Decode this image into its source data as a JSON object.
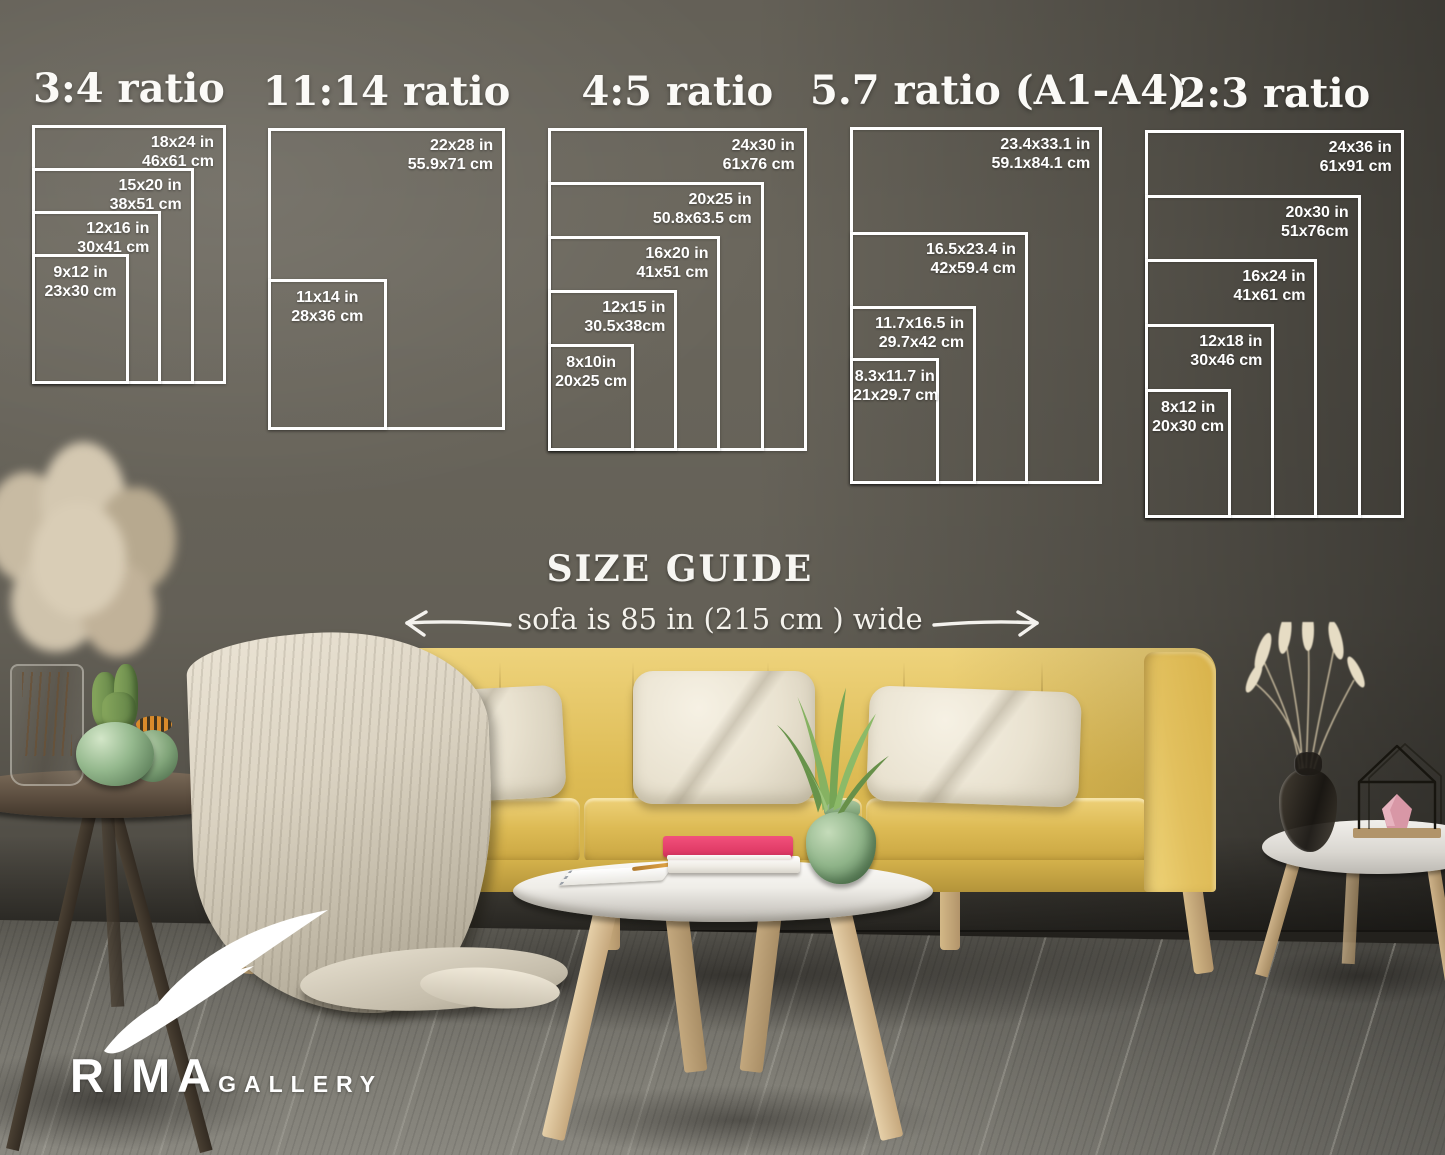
{
  "size_guide": {
    "heading": "SIZE GUIDE",
    "sofa_note": "sofa is 85 in (215 cm ) wide",
    "px_per_inch": 10.78,
    "frame_color": "#ffffff",
    "groups": [
      {
        "title": "3:4 ratio",
        "x": 32,
        "y": 125,
        "sizes": [
          {
            "w": 18,
            "h": 24,
            "inches": "18x24 in",
            "cm": "46x61 cm"
          },
          {
            "w": 15,
            "h": 20,
            "inches": "15x20 in",
            "cm": "38x51 cm"
          },
          {
            "w": 12,
            "h": 16,
            "inches": "12x16 in",
            "cm": "30x41 cm"
          },
          {
            "w": 9,
            "h": 12,
            "inches": "9x12 in",
            "cm": "23x30 cm",
            "label_align": "center"
          }
        ]
      },
      {
        "title": "11:14 ratio",
        "x": 268,
        "y": 128,
        "sizes": [
          {
            "w": 22,
            "h": 28,
            "inches": "22x28 in",
            "cm": "55.9x71 cm"
          },
          {
            "w": 11,
            "h": 14,
            "inches": "11x14 in",
            "cm": "28x36 cm",
            "label_align": "center"
          }
        ]
      },
      {
        "title": "4:5 ratio",
        "x": 548,
        "y": 128,
        "sizes": [
          {
            "w": 24,
            "h": 30,
            "inches": "24x30 in",
            "cm": "61x76 cm"
          },
          {
            "w": 20,
            "h": 25,
            "inches": "20x25 in",
            "cm": "50.8x63.5 cm"
          },
          {
            "w": 16,
            "h": 20,
            "inches": "16x20 in",
            "cm": "41x51 cm"
          },
          {
            "w": 12,
            "h": 15,
            "inches": "12x15 in",
            "cm": "30.5x38cm"
          },
          {
            "w": 8,
            "h": 10,
            "inches": "8x10in",
            "cm": "20x25 cm",
            "label_align": "center"
          }
        ]
      },
      {
        "title": "5.7 ratio (A1-A4)",
        "x": 850,
        "y": 127,
        "sizes": [
          {
            "w": 23.4,
            "h": 33.1,
            "inches": "23.4x33.1 in",
            "cm": "59.1x84.1 cm"
          },
          {
            "w": 16.5,
            "h": 23.4,
            "inches": "16.5x23.4 in",
            "cm": "42x59.4 cm"
          },
          {
            "w": 11.7,
            "h": 16.5,
            "inches": "11.7x16.5 in",
            "cm": "29.7x42 cm"
          },
          {
            "w": 8.3,
            "h": 11.7,
            "inches": "8.3x11.7 in",
            "cm": "21x29.7 cm",
            "label_align": "center"
          }
        ]
      },
      {
        "title": "2:3 ratio",
        "x": 1145,
        "y": 130,
        "sizes": [
          {
            "w": 24,
            "h": 36,
            "inches": "24x36 in",
            "cm": "61x91 cm"
          },
          {
            "w": 20,
            "h": 30,
            "inches": "20x30 in",
            "cm": "51x76cm"
          },
          {
            "w": 16,
            "h": 24,
            "inches": "16x24 in",
            "cm": "41x61 cm"
          },
          {
            "w": 12,
            "h": 18,
            "inches": "12x18 in",
            "cm": "30x46 cm"
          },
          {
            "w": 8,
            "h": 12,
            "inches": "8x12 in",
            "cm": "20x30 cm",
            "label_align": "center"
          }
        ]
      }
    ]
  },
  "logo": {
    "brand": "RIMA",
    "suffix": "GALLERY"
  },
  "palette": {
    "wall": "#6a665c",
    "floor": "#6f6d66",
    "sofa_yellow": "#ddbb54",
    "pillow_cream": "#ece5d3",
    "blanket_beige": "#d5cdbc",
    "table_white": "#f2f0ec",
    "wood_light": "#d9c29a",
    "wood_dark": "#4a4036",
    "plant_green": "#7fa85c",
    "vase_green": "#8fb489",
    "book_pink": "#e8436f",
    "candle_pink": "#d897a6",
    "frame_white": "#ffffff"
  }
}
